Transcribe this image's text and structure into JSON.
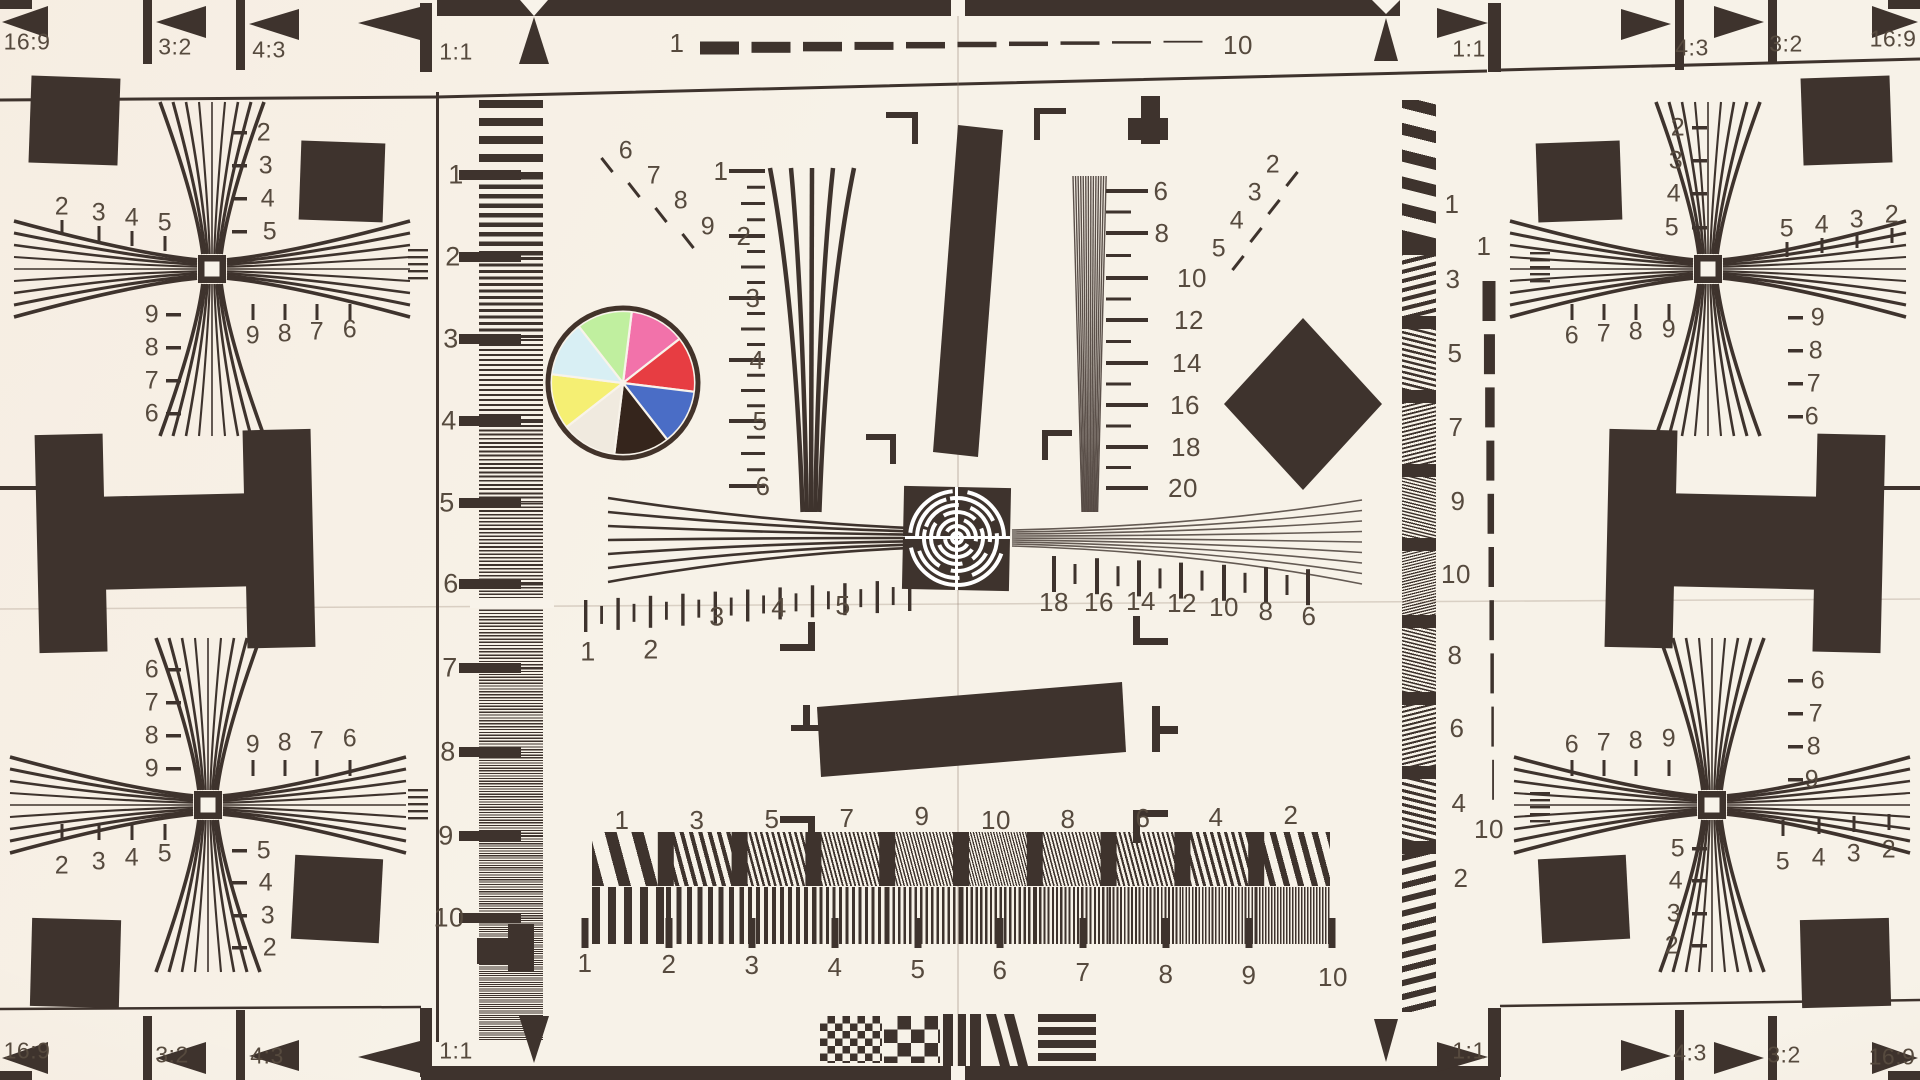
{
  "colors": {
    "paper": "#f8f3ea",
    "ink": "#3e332d",
    "label": "#564a3e"
  },
  "aspect_markers": {
    "top_left": [
      "16:9",
      "3:2",
      "4:3",
      "1:1"
    ],
    "top_right": [
      "1:1",
      "4:3",
      "3:2",
      "16:9"
    ],
    "bottom_left": [
      "16:9",
      "3:2",
      "4:3",
      "1:1"
    ],
    "bottom_right": [
      "1:1",
      "4:3",
      "3:2",
      "16:9"
    ]
  },
  "dash_scales": {
    "top": {
      "start": "1",
      "end": "10"
    },
    "right": {
      "start": "1",
      "end": "10"
    }
  },
  "scales": {
    "left_ruler": [
      "1",
      "2",
      "3",
      "4",
      "5",
      "6",
      "7",
      "8",
      "9",
      "10"
    ],
    "center_wedge": [
      "1",
      "2",
      "3",
      "4",
      "5",
      "6"
    ],
    "fine_wedge": [
      "6",
      "8",
      "10",
      "12",
      "14",
      "16",
      "18",
      "20"
    ],
    "horizontal_left": [
      "1",
      "2",
      "3",
      "4",
      "5"
    ],
    "horizontal_right": [
      "18",
      "16",
      "14",
      "12",
      "10",
      "8",
      "6"
    ],
    "burst_top": [
      "1",
      "3",
      "5",
      "7",
      "9",
      "10",
      "8",
      "6",
      "4",
      "2"
    ],
    "burst_bottom": [
      "1",
      "2",
      "3",
      "4",
      "5",
      "6",
      "7",
      "8",
      "9",
      "10"
    ],
    "right_burst": [
      "1",
      "3",
      "5",
      "7",
      "9",
      "10",
      "8",
      "6",
      "4",
      "2"
    ],
    "diag_fan_left": [
      "6",
      "7",
      "8",
      "9"
    ],
    "diag_fan_right": [
      "2",
      "3",
      "4",
      "5"
    ]
  },
  "corner_targets": {
    "top_left": {
      "top": [
        "2",
        "3",
        "4",
        "5"
      ],
      "right": [
        "2",
        "3",
        "4",
        "5"
      ],
      "left": [
        "9",
        "8",
        "7",
        "6"
      ],
      "bottom": [
        "9",
        "8",
        "7",
        "6"
      ]
    },
    "top_right": {
      "top": [
        "5",
        "4",
        "3",
        "2"
      ],
      "left": [
        "2",
        "3",
        "4",
        "5"
      ],
      "right": [
        "9",
        "8",
        "7",
        "6"
      ],
      "bottom": [
        "6",
        "7",
        "8",
        "9"
      ]
    },
    "bottom_left": {
      "top": [
        "9",
        "8",
        "7",
        "6"
      ],
      "left": [
        "6",
        "7",
        "8",
        "9"
      ],
      "right": [
        "5",
        "4",
        "3",
        "2"
      ],
      "bottom": [
        "2",
        "3",
        "4",
        "5"
      ]
    },
    "bottom_right": {
      "top": [
        "6",
        "7",
        "8",
        "9"
      ],
      "left": [
        "5",
        "4",
        "3",
        "2"
      ],
      "right": [
        "6",
        "7",
        "8",
        "9"
      ],
      "bottom": [
        "5",
        "4",
        "3",
        "2"
      ]
    }
  },
  "color_wheel": {
    "segments": [
      {
        "name": "pink",
        "hex": "#f272aa"
      },
      {
        "name": "red",
        "hex": "#e73d42"
      },
      {
        "name": "blue",
        "hex": "#4a6dc6"
      },
      {
        "name": "dark-brown",
        "hex": "#35251c"
      },
      {
        "name": "cream",
        "hex": "#f0eadf"
      },
      {
        "name": "yellow",
        "hex": "#f5ef73"
      },
      {
        "name": "pale-cyan",
        "hex": "#d8eff4"
      },
      {
        "name": "pale-green",
        "hex": "#c0ef9f"
      }
    ]
  }
}
